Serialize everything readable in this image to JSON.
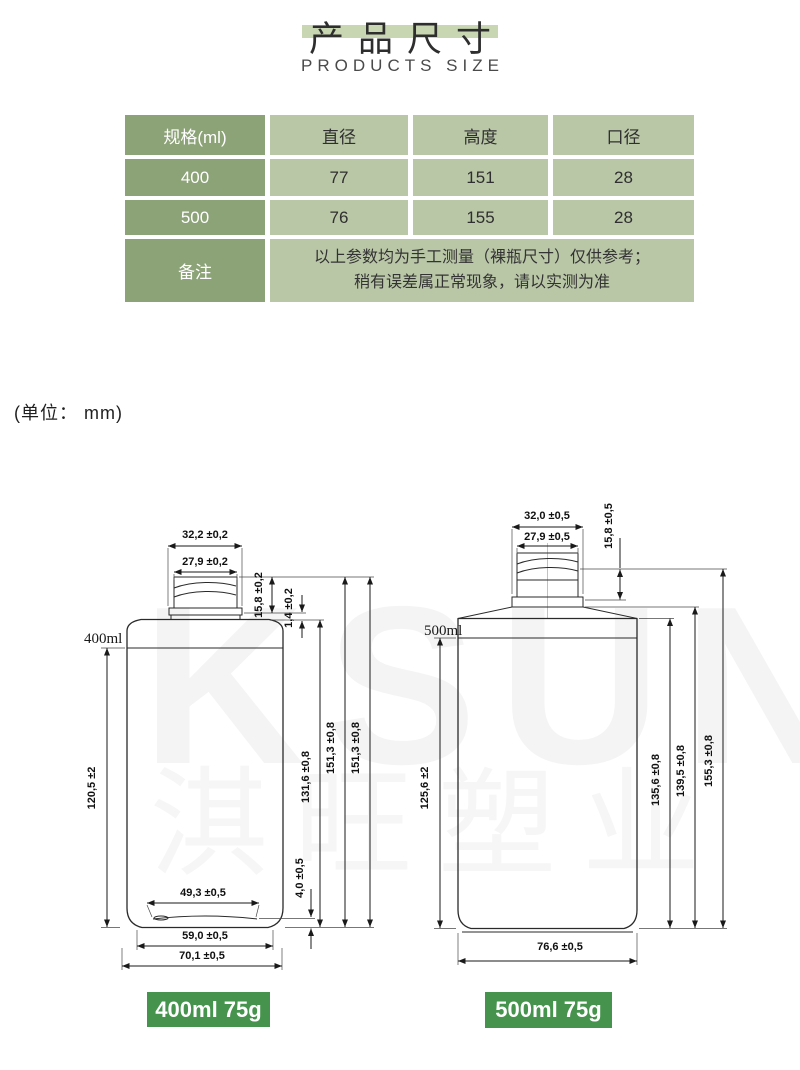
{
  "page": {
    "title_cn": "产品尺寸",
    "title_en": "PRODUCTS SIZE",
    "unit_note": "(单位： mm)"
  },
  "colors": {
    "title_band": "#c8d7b2",
    "table_header_green": "#8ca277",
    "table_cell_green": "#b9c7a7",
    "badge_green": "#45934c"
  },
  "table": {
    "headers": [
      "规格(ml)",
      "直径",
      "高度",
      "口径"
    ],
    "rows": [
      [
        "400",
        "77",
        "151",
        "28"
      ],
      [
        "500",
        "76",
        "155",
        "28"
      ]
    ],
    "note_label": "备注",
    "note_line1": "以上参数均为手工测量（裸瓶尺寸）仅供参考；",
    "note_line2": "稍有误差属正常现象，请以实测为准"
  },
  "watermark": {
    "latin": "KSUN",
    "cn": "淇旺塑业"
  },
  "left_bottle": {
    "volume_label": "400ml",
    "badge": "400ml 75g",
    "dims": {
      "top_outer": "32,2 ±0,2",
      "top_inner": "27,9 ±0,2",
      "neck_height": "15,8 ±0,2",
      "neck_gap": "1,4 ±0,2",
      "body_height": "120,5 ±2",
      "shoulder_height": "131,6 ±0,8",
      "total_height_1": "151,3 ±0,8",
      "total_height_2": "151,3 ±0,8",
      "base_recess": "4,0 ±0,5",
      "base_inner": "49,3 ±0,5",
      "base_mid": "59,0 ±0,5",
      "base_outer": "70,1 ±0,5"
    }
  },
  "right_bottle": {
    "volume_label": "500ml",
    "badge": "500ml 75g",
    "dims": {
      "top_outer": "32,0 ±0,5",
      "top_inner": "27,9 ±0,5",
      "neck_height": "15,8 ±0,5",
      "body_height": "125,6 ±2",
      "shoulder_height": "135,6 ±0,8",
      "mid_height": "139,5 ±0,8",
      "total_height": "155,3 ±0,8",
      "base_width": "76,6 ±0,5"
    }
  }
}
